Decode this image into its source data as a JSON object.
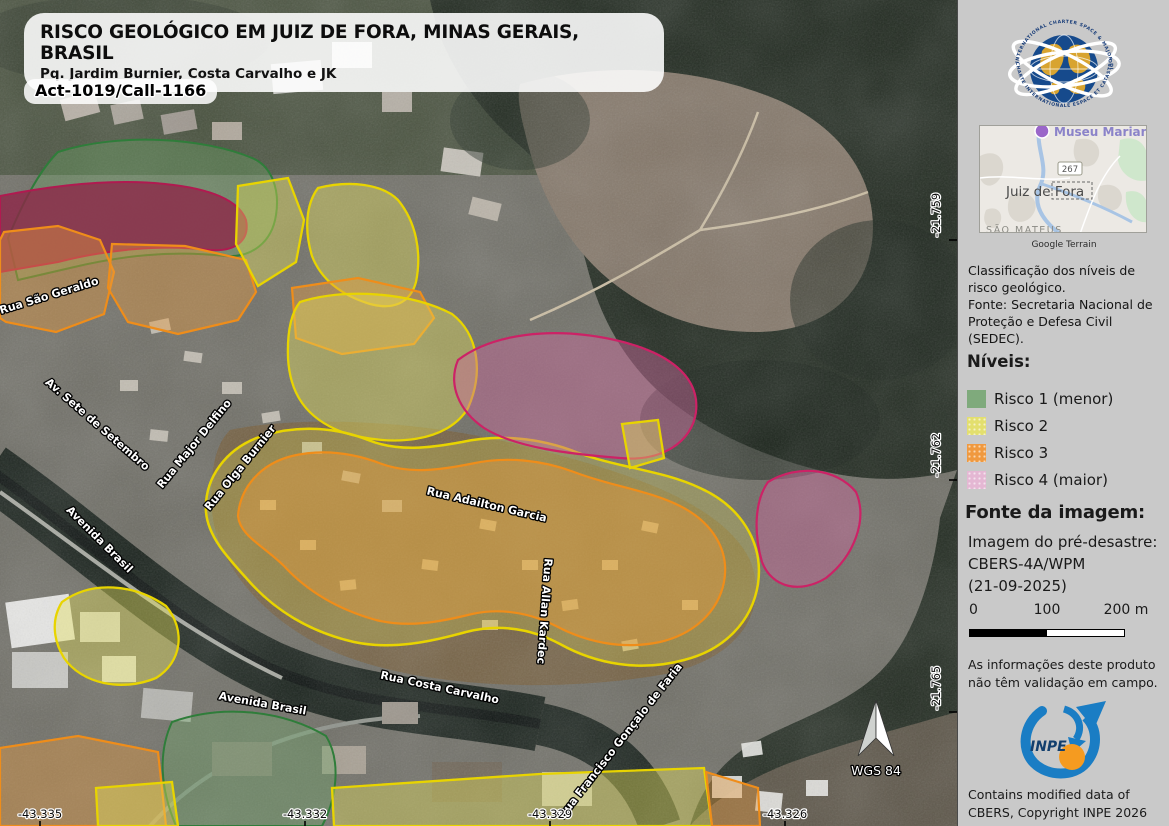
{
  "title_block": {
    "title": "RISCO GEOLÓGICO EM JUIZ DE FORA, MINAS GERAIS, BRASIL",
    "subtitle": "Pq. Jardim Burnier, Costa Carvalho e JK",
    "activation_code": "Act-1019/Call-1166"
  },
  "map": {
    "street_labels": [
      "Rua São Geraldo",
      "Av. Sete de Setembro",
      "Rua Major Delfino",
      "Rua Olga Burnier",
      "Avenida Brasil",
      "Rua Adailton Garcia",
      "Rua Allan Kardec",
      "Rua Costa Carvalho",
      "Avenida Brasil",
      "Rua Francisco Gonçalo de Faria"
    ],
    "latitude_labels": [
      "-21.759",
      "-21.762",
      "-21.765"
    ],
    "longitude_labels": [
      "-43.335",
      "-43.332",
      "-43.329",
      "-43.326"
    ],
    "datum": "WGS 84"
  },
  "sidebar": {
    "charter_logo": {
      "text_top": "INTERNATIONAL CHARTER SPACE & MAJOR DISASTERS",
      "text_bottom": "CHARTE INTERNATIONALE ESPACE ET CATASTROPHES MAJEURES"
    },
    "inset_map": {
      "poi_label": "Museu Mariano P",
      "route_badge": "267",
      "city_label": "Juiz de Fora",
      "district_label": "SÃO MATEUS",
      "caption": "Google Terrain"
    },
    "classification_note": "Classificação dos níveis de\nrisco geológico.\nFonte: Secretaria Nacional de\nProteção e Defesa Civil\n(SEDEC).",
    "levels_heading": "Níveis:",
    "legend": [
      {
        "label": "Risco 1 (menor)",
        "color": "#7faa7c"
      },
      {
        "label": "Risco 2",
        "color": "#e3df6e"
      },
      {
        "label": "Risco 3",
        "color": "#f0993f"
      },
      {
        "label": "Risco 4 (maior)",
        "color": "#e4b7d3"
      }
    ],
    "image_source_heading": "Fonte da imagem:",
    "image_source_text": "Imagem do pré-desastre:\nCBERS-4A/WPM\n(21-09-2025)",
    "scale_bar": {
      "labels": [
        "0",
        "100",
        "200 m"
      ]
    },
    "disclaimer": "As informações deste produto\nnão têm validação em campo.",
    "inpe_logo_label": "INPE",
    "copyright": "Contains modified data of\nCBERS, Copyright INPE 2026"
  }
}
